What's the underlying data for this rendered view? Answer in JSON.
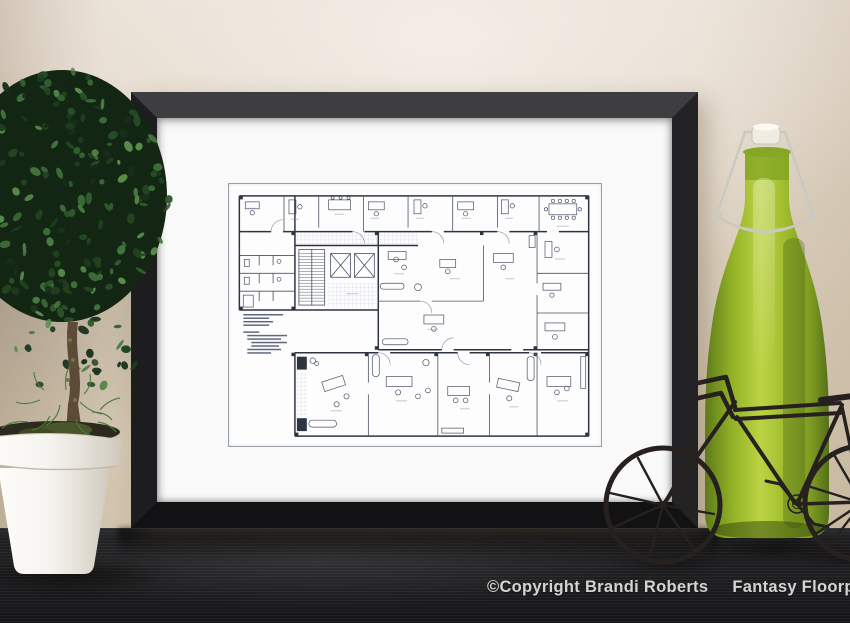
{
  "watermark": {
    "copyright": "©Copyright Brandi Roberts",
    "brand": "Fantasy Floorplans"
  },
  "palette": {
    "wall": "#d8cbb7",
    "wall_light": "#f3ede6",
    "table": "#202022",
    "frame_top": "#3e3e41",
    "frame_side": "#232326",
    "frame_dark": "#121214",
    "mat": "#f9f9f9",
    "paper": "#fdfdfe",
    "print_border": "#9aa0a8",
    "ink": "#4a5163",
    "ink_heavy": "#2e3442",
    "hatch": "#c6cbd6",
    "label": "#8791a8",
    "leaf_dark": "#1b3a1e",
    "leaf_mid": "#2f5a2c",
    "leaf_light": "#4a7d3f",
    "pot": "#f5f3ef",
    "trunk": "#5d4b37",
    "bottle_dark": "#5e7a19",
    "bottle_mid": "#93b227",
    "bottle_light": "#bcd344",
    "stopper": "#f0ece2",
    "wire": "#c9c9c2",
    "metal": "#26211f",
    "watermark_text": "#d4d4d4"
  }
}
